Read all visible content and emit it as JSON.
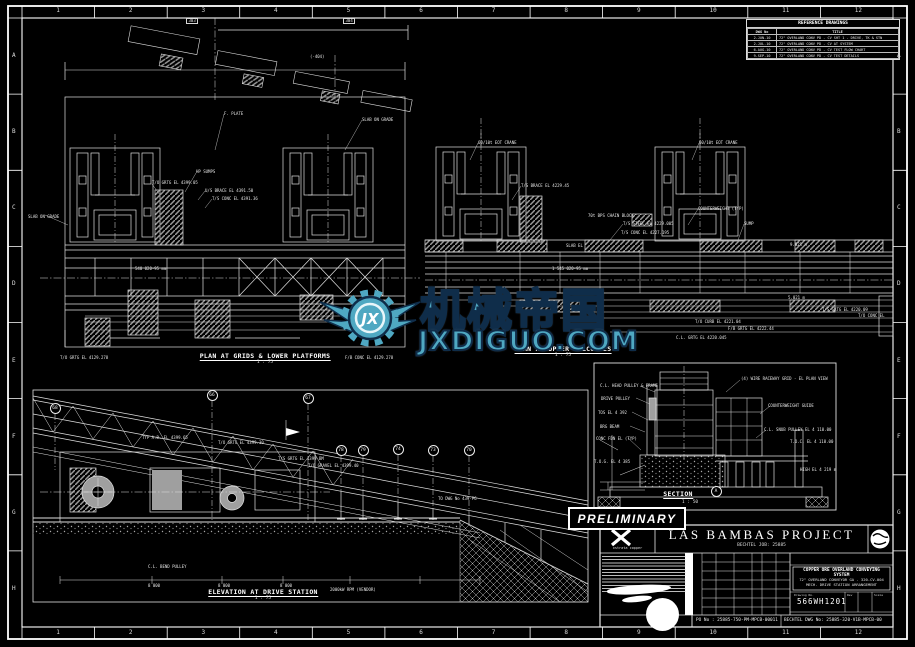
{
  "sheet": {
    "background": "#000000",
    "line_color": "#e6e6e6",
    "accent_teal": "#4FA8C2",
    "ruler": {
      "top": [
        "1",
        "2",
        "3",
        "4",
        "5",
        "6",
        "7",
        "8",
        "9",
        "10",
        "11",
        "12"
      ],
      "bottom": [
        "1",
        "2",
        "3",
        "4",
        "5",
        "6",
        "7",
        "8",
        "9",
        "10",
        "11",
        "12"
      ],
      "left": [
        "A",
        "B",
        "C",
        "D",
        "E",
        "F",
        "G",
        "H"
      ],
      "right": [
        "A",
        "B",
        "C",
        "D",
        "E",
        "F",
        "G",
        "H"
      ]
    }
  },
  "stamp": {
    "label": "PRELIMINARY"
  },
  "watermark": {
    "logo_text": "JX",
    "cn_text": "机械帝国",
    "url_text": "JXDIGUO.COM",
    "color": "#4FA8C2"
  },
  "views": [
    {
      "id": "plan-lower",
      "title": "PLAN AT GRIDS & LOWER PLATFORMS",
      "scale": "1 : 75"
    },
    {
      "id": "plan-upper",
      "title": "PLAN AT UPPER BALCONIES",
      "scale": "1 : 75"
    },
    {
      "id": "elevation",
      "title": "ELEVATION AT DRIVE STATION",
      "scale": "1 : 75"
    },
    {
      "id": "section",
      "title": "SECTION",
      "scale": "1 : 50",
      "bubble": "A"
    }
  ],
  "reference_table": {
    "title": "REFERENCE DRAWINGS",
    "columns": [
      "DWG No",
      "TITLE"
    ],
    "rows": [
      [
        "2-JUN-10",
        "72\" OVERLAND CONV PD - CV SHT 1 - DRIVE, TK & STN"
      ],
      [
        "2-JUL-10",
        "72\" OVERLAND CONV PD - CV AT SYSTEM"
      ],
      [
        "6-AUG-10",
        "72\" OVERLAND CONV PD - CV TEST FLOW CHART"
      ],
      [
        "9-SEP-10",
        "72\" OVERLAND CONV PD - CV TEST DETAILS"
      ]
    ]
  },
  "title_block": {
    "project": "LAS BAMBAS PROJECT",
    "subtitle": "BECHTEL JOB: 25885",
    "company": "xstrata copper",
    "title_lines": {
      "l1": "COPPER ORE OVERLAND CONVEYING SYSTEM",
      "l2": "72\" OVERLAND CONVEYOR GA - 320-CV-004",
      "l3": "MECH. DRIVE STATION ARRANGEMENT"
    },
    "drawing_no_label": "Drawing No.",
    "drawing_no": "566WH1201",
    "rev_label": "Rev",
    "scale_label": "Scale",
    "po_no": "PO No : 25885-750-PM-MPCB-00011",
    "bechtel_dwg_no": "BECHTEL DWG No: 25885-320-V1B-MPCB-00"
  },
  "bubbles": [
    {
      "x": 55,
      "y": 408,
      "t": "68"
    },
    {
      "x": 212,
      "y": 395,
      "t": "66"
    },
    {
      "x": 308,
      "y": 398,
      "t": "67"
    },
    {
      "x": 341,
      "y": 450,
      "t": "78"
    },
    {
      "x": 363,
      "y": 450,
      "t": "79"
    },
    {
      "x": 398,
      "y": 449,
      "t": "74"
    },
    {
      "x": 433,
      "y": 450,
      "t": "73"
    },
    {
      "x": 469,
      "y": 450,
      "t": "70"
    },
    {
      "x": 716,
      "y": 491,
      "t": "A"
    }
  ],
  "annotations": [
    {
      "x": 310,
      "y": 55,
      "t": "(-404)"
    },
    {
      "x": 186,
      "y": 18,
      "t": "303",
      "b": 1
    },
    {
      "x": 343,
      "y": 18,
      "t": "304",
      "b": 1
    },
    {
      "x": 224,
      "y": 112,
      "t": "F. PLATE"
    },
    {
      "x": 362,
      "y": 118,
      "t": "SLAB ON GRADE"
    },
    {
      "x": 28,
      "y": 215,
      "t": "SLAB ON GRADE"
    },
    {
      "x": 196,
      "y": 170,
      "t": "HP SUMPS"
    },
    {
      "x": 152,
      "y": 181,
      "t": "T/O GRTG EL 4399.05"
    },
    {
      "x": 205,
      "y": 189,
      "t": "U/S BRACE EL 4391.50"
    },
    {
      "x": 212,
      "y": 197,
      "t": "T/S CONC EL 4391.36"
    },
    {
      "x": 135,
      "y": 267,
      "t": "540 020-95 mm"
    },
    {
      "x": 60,
      "y": 356,
      "t": "T/O GRTG EL 4129.278"
    },
    {
      "x": 345,
      "y": 356,
      "t": "F/B CONC EL 4129.278"
    },
    {
      "x": 478,
      "y": 141,
      "t": "60/10t EOT CRANE"
    },
    {
      "x": 699,
      "y": 141,
      "t": "60/10t EOT CRANE"
    },
    {
      "x": 521,
      "y": 184,
      "t": "T/S BRACE EL 4229.45"
    },
    {
      "x": 588,
      "y": 214,
      "t": "70t BPS CHAIN BLOCK"
    },
    {
      "x": 623,
      "y": 222,
      "t": "T/S STEEL EL 4229.005"
    },
    {
      "x": 621,
      "y": 231,
      "t": "T/S CONC EL 4227.195"
    },
    {
      "x": 698,
      "y": 207,
      "t": "COUNTERWEIGHT (TYP)"
    },
    {
      "x": 744,
      "y": 222,
      "t": "SUMP"
    },
    {
      "x": 566,
      "y": 244,
      "t": "SLAB EL"
    },
    {
      "x": 790,
      "y": 243,
      "t": "9.021 m"
    },
    {
      "x": 788,
      "y": 296,
      "t": "5.021 m"
    },
    {
      "x": 552,
      "y": 267,
      "t": "1 545 020-95 mm"
    },
    {
      "x": 822,
      "y": 308,
      "t": "T/S GRTG EL 4220.09"
    },
    {
      "x": 858,
      "y": 314,
      "t": "T/O CONC EL"
    },
    {
      "x": 695,
      "y": 320,
      "t": "T/O CURB EL 4221.04"
    },
    {
      "x": 728,
      "y": 327,
      "t": "F/B GRTG EL 4222.44"
    },
    {
      "x": 676,
      "y": 336,
      "t": "C.L. GRTG EL 4220.045"
    },
    {
      "x": 142,
      "y": 436,
      "t": "TYP A.B. EL 4399.65"
    },
    {
      "x": 218,
      "y": 441,
      "t": "T/O GRTG EL 4399.30"
    },
    {
      "x": 278,
      "y": 457,
      "t": "T/S GRTG EL 4399 BM"
    },
    {
      "x": 308,
      "y": 464,
      "t": "T/O GRAVEL EL 4399.40"
    },
    {
      "x": 438,
      "y": 497,
      "t": "TO DWG No 439-PG"
    },
    {
      "x": 148,
      "y": 565,
      "t": "C.L. BEND PULLEY"
    },
    {
      "x": 148,
      "y": 584,
      "t": "8 000"
    },
    {
      "x": 218,
      "y": 584,
      "t": "8 000"
    },
    {
      "x": 280,
      "y": 584,
      "t": "8 000"
    },
    {
      "x": 330,
      "y": 588,
      "t": "2000kW RPM (VENDOR)"
    },
    {
      "x": 600,
      "y": 384,
      "t": "C.L. HEAD PULLEY & FRAME"
    },
    {
      "x": 601,
      "y": 397,
      "t": "DRIVE PULLEY"
    },
    {
      "x": 598,
      "y": 411,
      "t": "TOS EL 4 392"
    },
    {
      "x": 600,
      "y": 425,
      "t": "BRG BEAM"
    },
    {
      "x": 596,
      "y": 437,
      "t": "CONC FDN EL (TYP)"
    },
    {
      "x": 594,
      "y": 460,
      "t": "T.O.G. EL 4 385"
    },
    {
      "x": 741,
      "y": 377,
      "t": "(4) WIRE RACEWAY GRID - EL PLAN VIEW"
    },
    {
      "x": 768,
      "y": 404,
      "t": "COUNTERWEIGHT GUIDE"
    },
    {
      "x": 764,
      "y": 428,
      "t": "C.L. SNUB PULLEY EL 4 110.00"
    },
    {
      "x": 790,
      "y": 440,
      "t": "T.O.C. EL 4 110.00"
    },
    {
      "x": 800,
      "y": 468,
      "t": "HIGH EL 4 219 m"
    }
  ]
}
